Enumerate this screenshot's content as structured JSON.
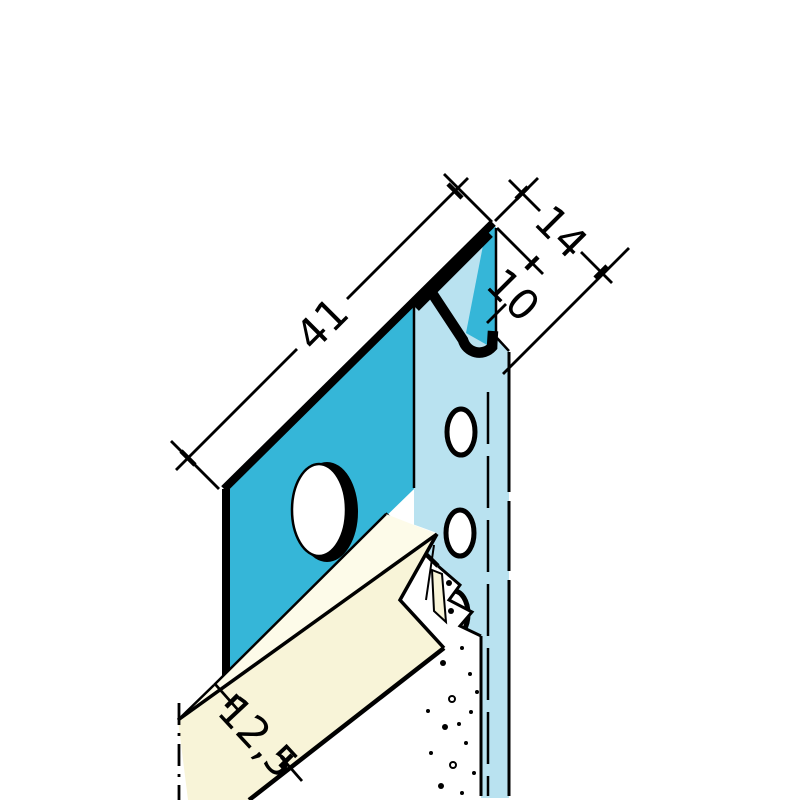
{
  "drawing": {
    "kind": "profile-cross-section-technical-drawing",
    "dimensions": [
      {
        "id": "flange-width",
        "label": "41"
      },
      {
        "id": "fold-depth-outer",
        "label": "14"
      },
      {
        "id": "fold-depth-inner",
        "label": "10"
      },
      {
        "id": "board-thickness",
        "label": "12,5"
      }
    ],
    "colors": {
      "profile_front": "#35b6d8",
      "profile_back": "#b9e2f0",
      "board_top": "#fdfbe9",
      "board_front": "#f8f4d8",
      "core_fill": "#ffffff",
      "line": "#000000",
      "background": "#ffffff"
    },
    "stipple_dots": [
      [
        449,
        583,
        3,
        0
      ],
      [
        451,
        611,
        3,
        0
      ],
      [
        462,
        648,
        2,
        0
      ],
      [
        443,
        663,
        3,
        0
      ],
      [
        470,
        674,
        2,
        0
      ],
      [
        452,
        699,
        3,
        1
      ],
      [
        471,
        712,
        2,
        0
      ],
      [
        445,
        727,
        3,
        0
      ],
      [
        466,
        743,
        2,
        0
      ],
      [
        431,
        753,
        2,
        0
      ],
      [
        453,
        765,
        3,
        1
      ],
      [
        474,
        773,
        2,
        0
      ],
      [
        441,
        786,
        3,
        0
      ],
      [
        462,
        793,
        2,
        0
      ],
      [
        428,
        711,
        2,
        0
      ],
      [
        477,
        692,
        2,
        0
      ],
      [
        459,
        724,
        2,
        0
      ]
    ]
  }
}
